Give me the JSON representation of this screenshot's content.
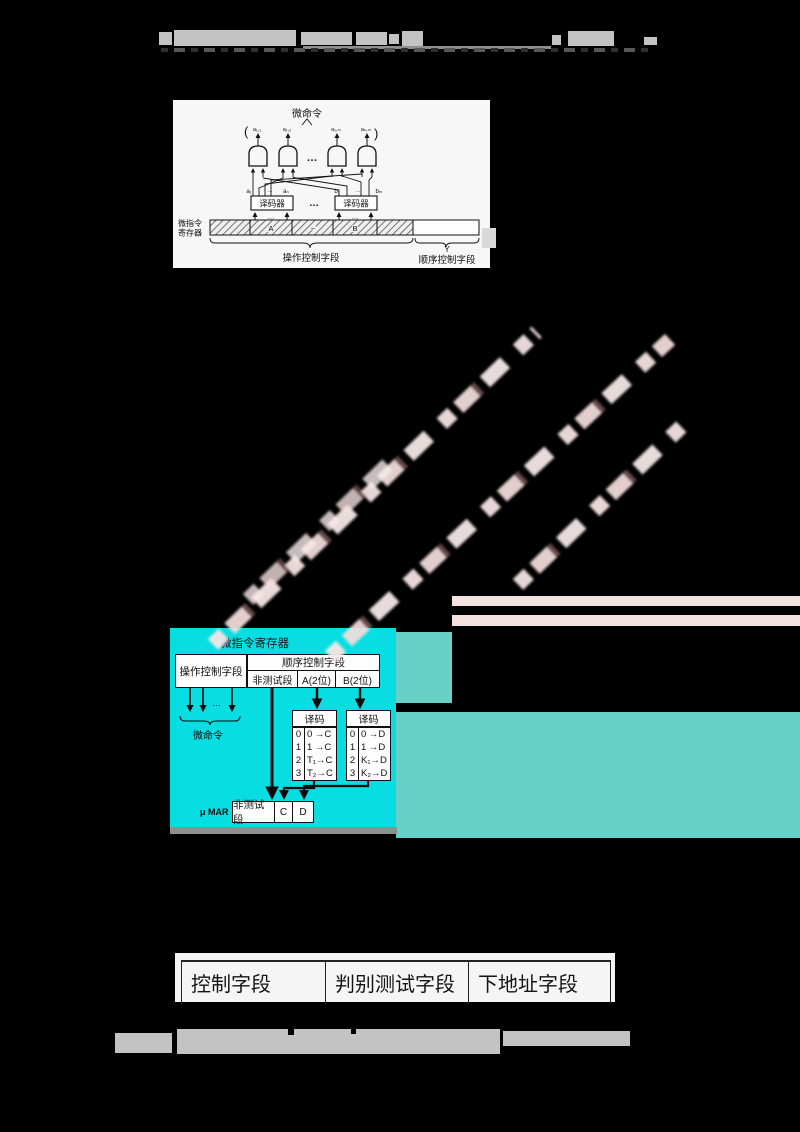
{
  "top_diagram": {
    "title": "微命令",
    "paren_left": "(",
    "paren_right": ")",
    "gate_labels": [
      "a₁,₁",
      "a₁,₂",
      "a₁,ₘ",
      "aₙ,ₘ"
    ],
    "dots": "…",
    "small_dots": "…",
    "decoders": [
      "译码器",
      "译码器"
    ],
    "input_labels": [
      "a₁",
      "aₙ",
      "b₁",
      "bₘ"
    ],
    "register_label": [
      "微指令",
      "寄存器"
    ],
    "segment_labels": [
      "A",
      "~",
      "B"
    ],
    "op_field_label": "操作控制字段",
    "y_label": "Y",
    "seq_field_label": "顺序控制字段"
  },
  "cyan_diagram": {
    "register_title": "微指令寄存器",
    "op_field": "操作控制字段",
    "seq_field": "顺序控制字段",
    "subfields": [
      "非测试段",
      "A(2位)",
      "B(2位)"
    ],
    "dots": "…",
    "micro_command": "微命令",
    "decoder_left": {
      "title": "译码",
      "rows": [
        [
          "0",
          "0 →C"
        ],
        [
          "1",
          "1 →C"
        ],
        [
          "2",
          "T₁→C"
        ],
        [
          "3",
          "T₂→C"
        ]
      ]
    },
    "decoder_right": {
      "title": "译码",
      "rows": [
        [
          "0",
          "0 →D"
        ],
        [
          "1",
          "1 →D"
        ],
        [
          "2",
          "K₁→D"
        ],
        [
          "3",
          "K₂→D"
        ]
      ]
    },
    "mar_label": "μ MAR",
    "mar_fields": [
      "非测试段",
      "C",
      "D"
    ]
  },
  "bottom_table": {
    "columns": [
      "控制字段",
      "判别测试字段",
      "下地址字段"
    ]
  },
  "colors": {
    "cyan_panel": "#08dee2",
    "teal_artifact": "#67d1c9",
    "pink_watermark": "#f6e4e2",
    "garbled_gray": "#c3c3c3"
  }
}
